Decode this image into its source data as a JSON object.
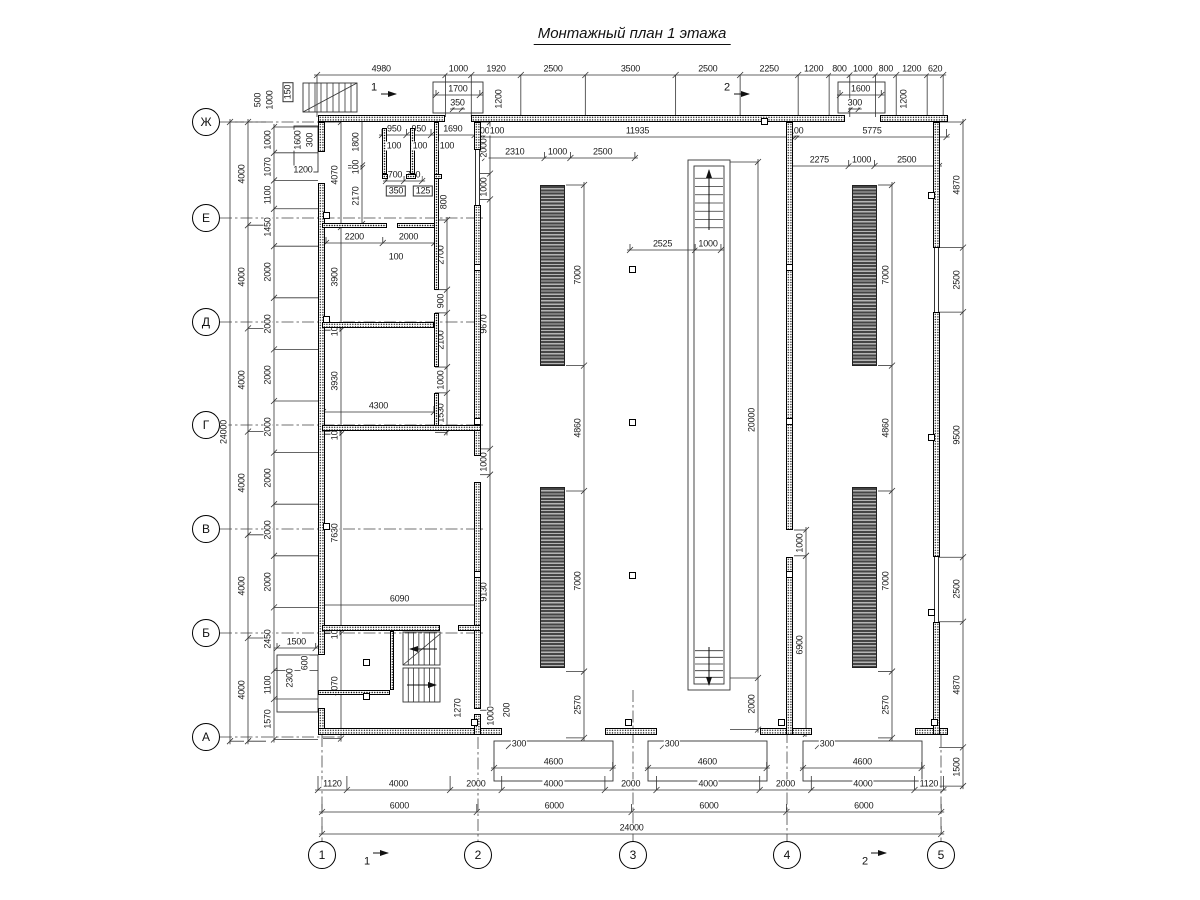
{
  "title": "Монтажный план 1 этажа",
  "scale_px_per_mm": 0.0258,
  "axes": {
    "rows": [
      {
        "label": "Ж",
        "y": 122
      },
      {
        "label": "Е",
        "y": 218
      },
      {
        "label": "Д",
        "y": 322
      },
      {
        "label": "Г",
        "y": 425
      },
      {
        "label": "В",
        "y": 529
      },
      {
        "label": "Б",
        "y": 633
      },
      {
        "label": "А",
        "y": 737
      }
    ],
    "rows_x": 206,
    "cols": [
      {
        "label": "1",
        "x": 322
      },
      {
        "label": "2",
        "x": 478
      },
      {
        "label": "3",
        "x": 633
      },
      {
        "label": "4",
        "x": 787
      },
      {
        "label": "5",
        "x": 941
      }
    ],
    "cols_y": 855
  },
  "section_marks": [
    {
      "label": "1",
      "x": 374,
      "y": 88,
      "arrow": [
        381,
        94,
        396,
        94
      ]
    },
    {
      "label": "2",
      "x": 727,
      "y": 88,
      "arrow": [
        734,
        94,
        749,
        94
      ]
    },
    {
      "label": "1",
      "x": 367,
      "y": 862,
      "arrow": [
        373,
        853,
        388,
        853
      ]
    },
    {
      "label": "2",
      "x": 865,
      "y": 862,
      "arrow": [
        871,
        853,
        886,
        853
      ]
    }
  ],
  "dim_chains": [
    {
      "n": "top-row",
      "d": "h",
      "x": 317,
      "y": 75,
      "e": 42,
      "v": [
        4980,
        1000,
        1920,
        2500,
        3500,
        2500,
        2250,
        1200,
        800,
        1000,
        800,
        1200,
        620
      ]
    },
    {
      "n": "hall-top-left",
      "d": "h",
      "x": 481,
      "y": 137,
      "e": -8,
      "v": [
        100,
        11935
      ]
    },
    {
      "n": "hall-top-right",
      "d": "h",
      "x": 795,
      "y": 137,
      "e": -8,
      "v": [
        100,
        5775
      ]
    },
    {
      "n": "strip-top-left",
      "d": "h",
      "x": 485,
      "y": 158,
      "e": -6,
      "v": [
        2310,
        1000,
        2500
      ]
    },
    {
      "n": "strip-top-right",
      "d": "h",
      "x": 790,
      "y": 166,
      "e": -6,
      "v": [
        2275,
        1000,
        2500
      ]
    },
    {
      "n": "shaft-offset",
      "d": "h",
      "x": 630,
      "y": 250,
      "e": -6,
      "v": [
        2525,
        1000
      ]
    },
    {
      "n": "room-2200",
      "d": "h",
      "x": 326,
      "y": 243,
      "e": -6,
      "v": [
        2200,
        2000
      ]
    },
    {
      "n": "room-4300",
      "d": "h",
      "x": 323,
      "y": 412,
      "e": -6,
      "v": [
        4300
      ]
    },
    {
      "n": "room-6090",
      "d": "h",
      "x": 321,
      "y": 605,
      "e": -6,
      "v": [
        6090
      ]
    },
    {
      "n": "wc-950",
      "d": "h",
      "x": 382,
      "y": 135,
      "e": -6,
      "v": [
        950,
        950,
        1690
      ]
    },
    {
      "n": "wc-doors",
      "d": "h",
      "x": 386,
      "y": 181,
      "e": -5,
      "v": [
        700,
        700
      ]
    },
    {
      "n": "porch-1500",
      "d": "h",
      "x": 277,
      "y": 648,
      "e": -5,
      "v": [
        1500
      ]
    },
    {
      "n": "door-1700",
      "d": "h",
      "x": 436,
      "y": 95,
      "e": -5,
      "v": [
        1700
      ]
    },
    {
      "n": "door-350",
      "d": "h",
      "x": 453,
      "y": 109,
      "e": -4,
      "v": [
        350
      ]
    },
    {
      "n": "door-1600",
      "d": "h",
      "x": 840,
      "y": 95,
      "e": -5,
      "v": [
        1600
      ]
    },
    {
      "n": "door-300",
      "d": "h",
      "x": 851,
      "y": 109,
      "e": -4,
      "v": [
        300
      ]
    },
    {
      "n": "ramp-a",
      "d": "h",
      "x": 494,
      "y": 768,
      "e": -6,
      "v": [
        4600
      ]
    },
    {
      "n": "ramp-b",
      "d": "h",
      "x": 648,
      "y": 768,
      "e": -6,
      "v": [
        4600
      ]
    },
    {
      "n": "ramp-c",
      "d": "h",
      "x": 803,
      "y": 768,
      "e": -6,
      "v": [
        4600
      ]
    },
    {
      "n": "bottom-row1",
      "d": "h",
      "x": 318,
      "y": 790,
      "e": -14,
      "v": [
        1120,
        4000,
        2000,
        4000,
        2000,
        4000,
        2000,
        4000,
        1120
      ]
    },
    {
      "n": "bottom-row2",
      "d": "h",
      "x": 322,
      "y": 812,
      "e": -8,
      "v": [
        6000,
        6000,
        6000,
        6000
      ]
    },
    {
      "n": "bottom-row3",
      "d": "h",
      "x": 322,
      "y": 834,
      "e": -8,
      "v": [
        24000
      ]
    },
    {
      "n": "axes-left",
      "d": "v",
      "x": 248,
      "y": 122,
      "e": 18,
      "v": [
        4000,
        4000,
        4000,
        4000,
        4000,
        4000
      ]
    },
    {
      "n": "total-left",
      "d": "v",
      "x": 230,
      "y": 122,
      "e": 14,
      "v": [
        24000
      ]
    },
    {
      "n": "inner-left",
      "d": "v",
      "x": 274,
      "y": 127,
      "e": 44,
      "v": [
        1000,
        1070,
        1100,
        1450,
        2000,
        2000,
        2000,
        2000,
        2000,
        2000,
        2000,
        2450,
        1100,
        1570
      ]
    },
    {
      "n": "wc-depth",
      "d": "v",
      "x": 362,
      "y": 119,
      "e": -14,
      "v": [
        1800,
        100,
        2170
      ]
    },
    {
      "n": "rooms-left",
      "d": "v",
      "x": 341,
      "y": 122,
      "e": -18,
      "v": [
        4070,
        3900,
        100,
        3930,
        100,
        7630,
        100,
        4070
      ]
    },
    {
      "n": "partition-right",
      "d": "v",
      "x": 447,
      "y": 220,
      "e": -12,
      "v": [
        2700,
        900,
        2100,
        1000,
        1530
      ]
    },
    {
      "n": "hall-west-wall",
      "d": "v",
      "x": 490,
      "y": 122,
      "e": -10,
      "v": [
        2000,
        1000,
        9670,
        1000,
        9130
      ]
    },
    {
      "n": "strips-left",
      "d": "v",
      "x": 584,
      "y": 185,
      "e": -18,
      "v": [
        7000,
        4860,
        7000,
        2570
      ]
    },
    {
      "n": "strips-right",
      "d": "v",
      "x": 892,
      "y": 185,
      "e": -14,
      "v": [
        7000,
        4860,
        7000,
        2570
      ]
    },
    {
      "n": "shaft-length",
      "d": "v",
      "x": 758,
      "y": 162,
      "e": -28,
      "v": [
        20000,
        2000
      ]
    },
    {
      "n": "divider-wall",
      "d": "v",
      "x": 806,
      "y": 530,
      "e": -12,
      "v": [
        1000,
        6900
      ]
    },
    {
      "n": "right-outer",
      "d": "v",
      "x": 963,
      "y": 122,
      "e": -24,
      "v": [
        4870,
        2500,
        9500,
        2500,
        4870,
        1500
      ]
    }
  ],
  "labels": [
    {
      "t": "500",
      "x": 258,
      "y": 100,
      "r": 1
    },
    {
      "t": "1000",
      "x": 270,
      "y": 100,
      "r": 1
    },
    {
      "t": "150",
      "x": 288,
      "y": 92,
      "r": 1,
      "b": 1
    },
    {
      "t": "1600",
      "x": 298,
      "y": 140,
      "r": 1
    },
    {
      "t": "300",
      "x": 310,
      "y": 140,
      "r": 1
    },
    {
      "t": "1200",
      "x": 303,
      "y": 170
    },
    {
      "t": "1200",
      "x": 499,
      "y": 99,
      "r": 1
    },
    {
      "t": "1200",
      "x": 904,
      "y": 99,
      "r": 1
    },
    {
      "t": "100",
      "x": 394,
      "y": 146
    },
    {
      "t": "100",
      "x": 420,
      "y": 146
    },
    {
      "t": "100",
      "x": 447,
      "y": 146
    },
    {
      "t": "100",
      "x": 497,
      "y": 131
    },
    {
      "t": "350",
      "x": 396,
      "y": 191,
      "b": 1
    },
    {
      "t": "125",
      "x": 423,
      "y": 191,
      "b": 1
    },
    {
      "t": "100",
      "x": 396,
      "y": 257
    },
    {
      "t": "800",
      "x": 444,
      "y": 202,
      "r": 1
    },
    {
      "t": "600",
      "x": 305,
      "y": 663,
      "r": 1
    },
    {
      "t": "2300",
      "x": 290,
      "y": 678,
      "r": 1
    },
    {
      "t": "1270",
      "x": 458,
      "y": 708,
      "r": 1
    },
    {
      "t": "1000",
      "x": 491,
      "y": 716,
      "r": 1
    },
    {
      "t": "200",
      "x": 507,
      "y": 710,
      "r": 1
    },
    {
      "t": "300",
      "x": 519,
      "y": 744
    },
    {
      "t": "300",
      "x": 672,
      "y": 744
    },
    {
      "t": "300",
      "x": 827,
      "y": 744
    }
  ],
  "walls": [
    [
      318,
      115,
      127,
      7
    ],
    [
      471,
      115,
      374,
      7
    ],
    [
      880,
      115,
      68,
      7
    ],
    [
      318,
      122,
      7,
      30
    ],
    [
      318,
      183,
      7,
      472
    ],
    [
      318,
      708,
      7,
      27
    ],
    [
      318,
      728,
      184,
      7
    ],
    [
      605,
      728,
      52,
      7
    ],
    [
      760,
      728,
      52,
      7
    ],
    [
      915,
      728,
      33,
      7
    ],
    [
      933,
      122,
      7,
      126
    ],
    [
      933,
      312,
      7,
      245
    ],
    [
      933,
      622,
      7,
      113
    ],
    [
      474,
      122,
      7,
      28
    ],
    [
      474,
      205,
      7,
      251
    ],
    [
      474,
      482,
      7,
      227
    ],
    [
      474,
      714,
      7,
      21
    ],
    [
      786,
      122,
      7,
      408
    ],
    [
      786,
      557,
      7,
      178
    ],
    [
      382,
      128,
      5,
      46
    ],
    [
      410,
      128,
      5,
      46
    ],
    [
      434,
      122,
      5,
      168
    ],
    [
      434,
      313,
      5,
      54
    ],
    [
      434,
      393,
      5,
      38
    ],
    [
      382,
      174,
      6,
      5
    ],
    [
      406,
      174,
      10,
      5
    ],
    [
      434,
      174,
      8,
      5
    ],
    [
      322,
      223,
      65,
      5
    ],
    [
      397,
      223,
      38,
      5
    ],
    [
      322,
      322,
      112,
      6
    ],
    [
      322,
      425,
      159,
      6
    ],
    [
      322,
      625,
      118,
      6
    ],
    [
      458,
      625,
      23,
      6
    ],
    [
      318,
      690,
      72,
      5
    ],
    [
      390,
      631,
      4,
      59
    ]
  ],
  "windows": [
    [
      934,
      248,
      5,
      64
    ],
    [
      934,
      557,
      5,
      65
    ],
    [
      475,
      150,
      5,
      55
    ]
  ],
  "squares": [
    [
      764,
      121
    ],
    [
      477,
      267
    ],
    [
      477,
      421
    ],
    [
      477,
      574
    ],
    [
      789,
      267
    ],
    [
      789,
      421
    ],
    [
      789,
      574
    ],
    [
      632,
      269
    ],
    [
      632,
      422
    ],
    [
      632,
      575
    ],
    [
      326,
      215
    ],
    [
      326,
      319
    ],
    [
      326,
      526
    ],
    [
      931,
      195
    ],
    [
      931,
      437
    ],
    [
      931,
      612
    ],
    [
      474,
      722
    ],
    [
      628,
      722
    ],
    [
      781,
      722
    ],
    [
      934,
      722
    ],
    [
      366,
      662
    ],
    [
      366,
      696
    ]
  ],
  "strips": [
    [
      540,
      185,
      25,
      181
    ],
    [
      540,
      487,
      25,
      181
    ],
    [
      852,
      185,
      25,
      181
    ],
    [
      852,
      487,
      25,
      181
    ]
  ],
  "thin_rects": [
    [
      433,
      82,
      50,
      31
    ],
    [
      838,
      82,
      47,
      31
    ],
    [
      294,
      126,
      24,
      46
    ],
    [
      277,
      655,
      41,
      57
    ],
    [
      494,
      741,
      119,
      40
    ],
    [
      648,
      741,
      119,
      40
    ],
    [
      803,
      741,
      119,
      40
    ],
    [
      688,
      160,
      42,
      530
    ],
    [
      694,
      166,
      30,
      518
    ],
    [
      303,
      83,
      54,
      29
    ],
    [
      403,
      632,
      37,
      33
    ],
    [
      403,
      668,
      37,
      34
    ]
  ],
  "lines": [
    [
      303,
      112,
      357,
      83
    ],
    [
      403,
      665,
      440,
      634
    ],
    [
      506,
      749,
      514,
      741
    ],
    [
      660,
      749,
      668,
      741
    ],
    [
      815,
      749,
      823,
      741
    ]
  ],
  "axis_lines": [
    [
      220,
      122,
      340,
      122
    ],
    [
      220,
      218,
      483,
      218
    ],
    [
      220,
      322,
      483,
      322
    ],
    [
      220,
      425,
      483,
      425
    ],
    [
      220,
      529,
      483,
      529
    ],
    [
      220,
      633,
      483,
      633
    ],
    [
      220,
      737,
      340,
      737
    ],
    [
      322,
      735,
      322,
      842
    ],
    [
      478,
      737,
      478,
      842
    ],
    [
      633,
      690,
      633,
      842
    ],
    [
      787,
      690,
      787,
      842
    ],
    [
      941,
      735,
      941,
      842
    ]
  ],
  "arrows": [
    [
      437,
      649,
      410,
      649
    ],
    [
      407,
      685,
      436,
      685
    ],
    [
      709,
      230,
      709,
      170
    ],
    [
      709,
      647,
      709,
      685
    ]
  ],
  "stairs": [
    {
      "x": 303,
      "y": 83,
      "w": 54,
      "h": 29,
      "n": 8,
      "o": "v"
    },
    {
      "x": 403,
      "y": 632,
      "w": 37,
      "h": 33,
      "n": 6,
      "o": "v"
    },
    {
      "x": 403,
      "y": 668,
      "w": 37,
      "h": 34,
      "n": 6,
      "o": "v"
    },
    {
      "x": 695,
      "y": 170,
      "w": 28,
      "h": 66,
      "n": 7,
      "o": "h"
    },
    {
      "x": 695,
      "y": 644,
      "w": 28,
      "h": 40,
      "n": 5,
      "o": "h"
    }
  ]
}
